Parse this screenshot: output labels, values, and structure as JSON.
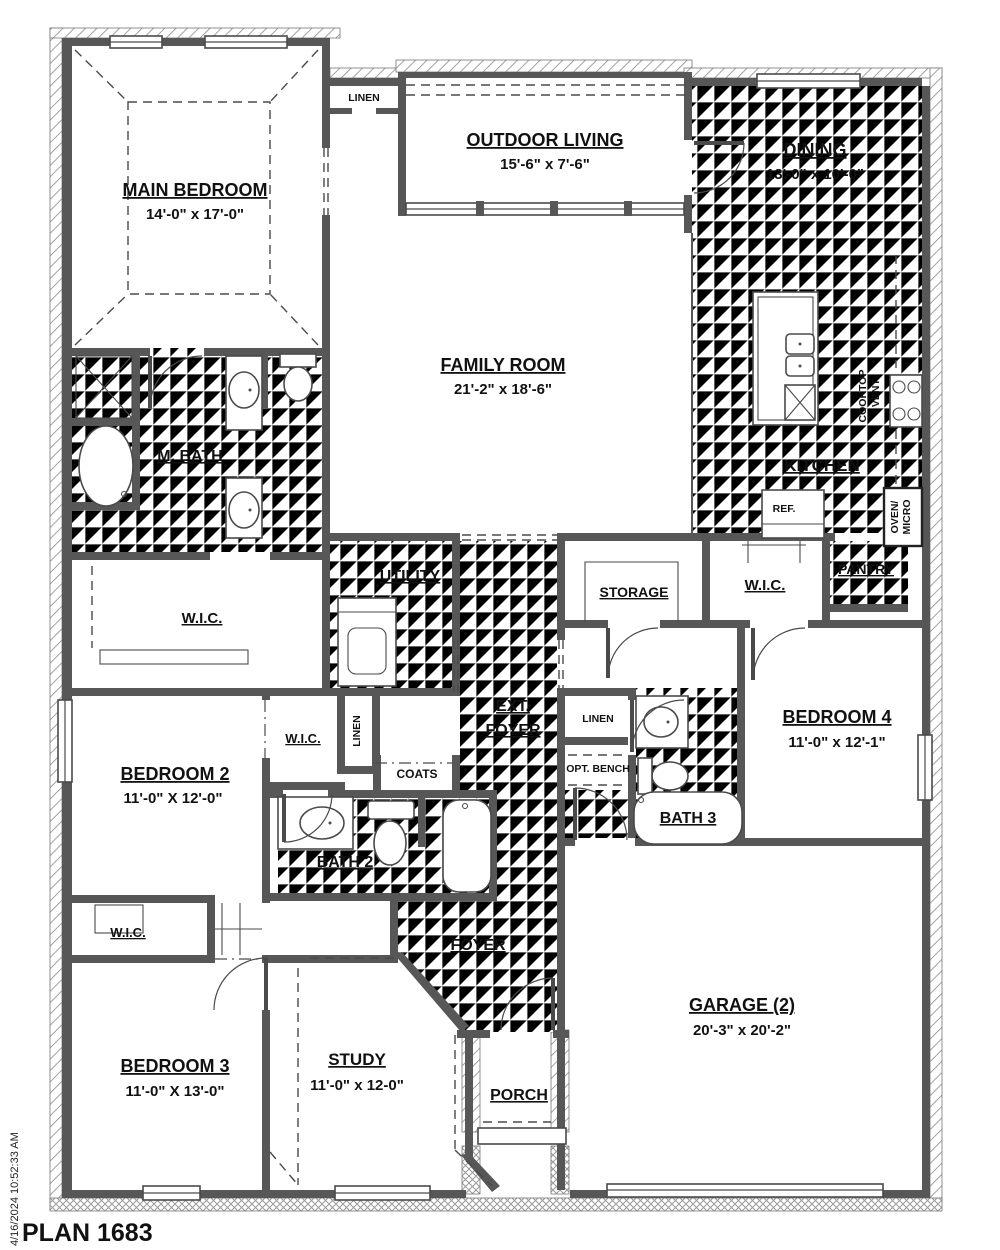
{
  "plan": {
    "title": "PLAN 1683",
    "timestamp": "4/16/2024 10:52:33 AM"
  },
  "rooms": {
    "main_bedroom": {
      "name": "MAIN BEDROOM",
      "dims": "14'-0\" x 17'-0\""
    },
    "outdoor_living": {
      "name": "OUTDOOR LIVING",
      "dims": "15'-6\" x 7'-6\""
    },
    "dining": {
      "name": "DINING",
      "dims": "13'-0\" x 10'-0\""
    },
    "family_room": {
      "name": "FAMILY ROOM",
      "dims": "21'-2\" x 18'-6\""
    },
    "kitchen": {
      "name": "KITCHEN"
    },
    "pantry": {
      "name": "PANTRY"
    },
    "m_bath": {
      "name": "M. BATH"
    },
    "master_wic": {
      "name": "W.I.C."
    },
    "utility": {
      "name": "UTILITY"
    },
    "storage": {
      "name": "STORAGE"
    },
    "wic_bed4": {
      "name": "W.I.C."
    },
    "ext_foyer": {
      "line1": "EXT.",
      "line2": "FOYER"
    },
    "linen_top": {
      "name": "LINEN"
    },
    "linen_hall": {
      "name": "LINEN"
    },
    "linen_side": {
      "name": "LINEN"
    },
    "opt_bench": {
      "name": "OPT. BENCH"
    },
    "bath3": {
      "name": "BATH 3"
    },
    "bedroom4": {
      "name": "BEDROOM 4",
      "dims": "11'-0\" x 12'-1\""
    },
    "bedroom2": {
      "name": "BEDROOM 2",
      "dims": "11'-0\" X 12'-0\""
    },
    "wic_bed2": {
      "name": "W.I.C."
    },
    "coats": {
      "name": "COATS"
    },
    "bath2": {
      "name": "BATH 2"
    },
    "wic_bed3": {
      "name": "W.I.C."
    },
    "bedroom3": {
      "name": "BEDROOM 3",
      "dims": "11'-0\" X 13'-0\""
    },
    "study": {
      "name": "STUDY",
      "dims": "11'-0\" x 12-0\""
    },
    "foyer": {
      "name": "FOYER"
    },
    "porch": {
      "name": "PORCH"
    },
    "garage": {
      "name": "GARAGE (2)",
      "dims": "20'-3\" x 20'-2\""
    }
  },
  "appliances": {
    "cooktop_line1": "COOKTOP",
    "cooktop_line2": "/ VENT",
    "ref": "REF.",
    "oven_line1": "OVEN/",
    "oven_line2": "MICRO"
  },
  "colors": {
    "wall": "#575757",
    "text": "#111111",
    "tile": "#c2c2c2"
  }
}
